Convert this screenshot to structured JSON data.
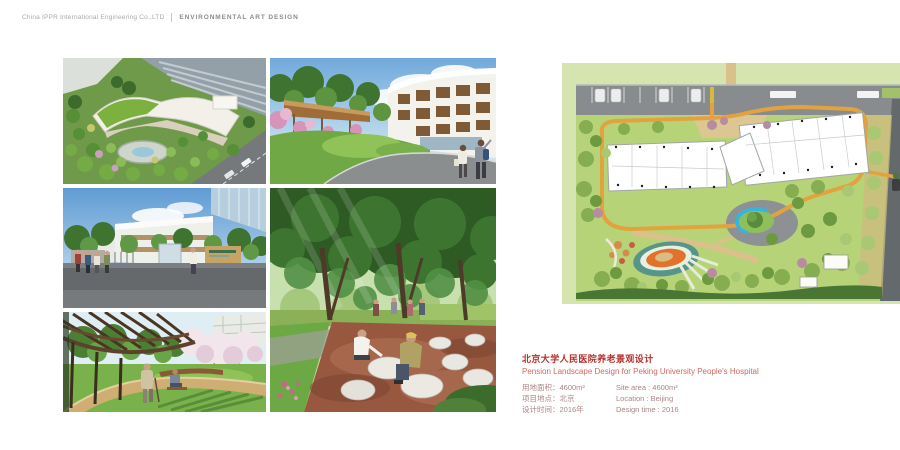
{
  "header": {
    "company": "China IPPR International Engineering Co.,LTD",
    "department": "ENVIRONMENTAL ART DESIGN"
  },
  "project": {
    "title_zh": "北京大学人民医院养老景观设计",
    "title_en": "Pension Landscape Design for Peking University People's Hospital",
    "details_zh": [
      "用地面积：4600m²",
      "项目地点：北京",
      "设计时间：2016年"
    ],
    "details_en": [
      "Site area : 4600m²",
      "Location : Beijing",
      "Design time : 2016"
    ]
  },
  "gallery": {
    "items": [
      "aerial-view-rendering",
      "courtyard-entrance-rendering",
      "main-gate-rendering",
      "tree-plaza-seating-rendering",
      "pergola-walkway-rendering"
    ]
  },
  "colors": {
    "title_red": "#b5302c",
    "subtitle_red": "#cd6a60",
    "detail_text": "#ab8584",
    "plan_site_green": "#b7d377",
    "plan_road_gray": "#888c8e",
    "plan_path_orange": "#e2a23f",
    "plan_water_blue": "#35b4dc"
  }
}
